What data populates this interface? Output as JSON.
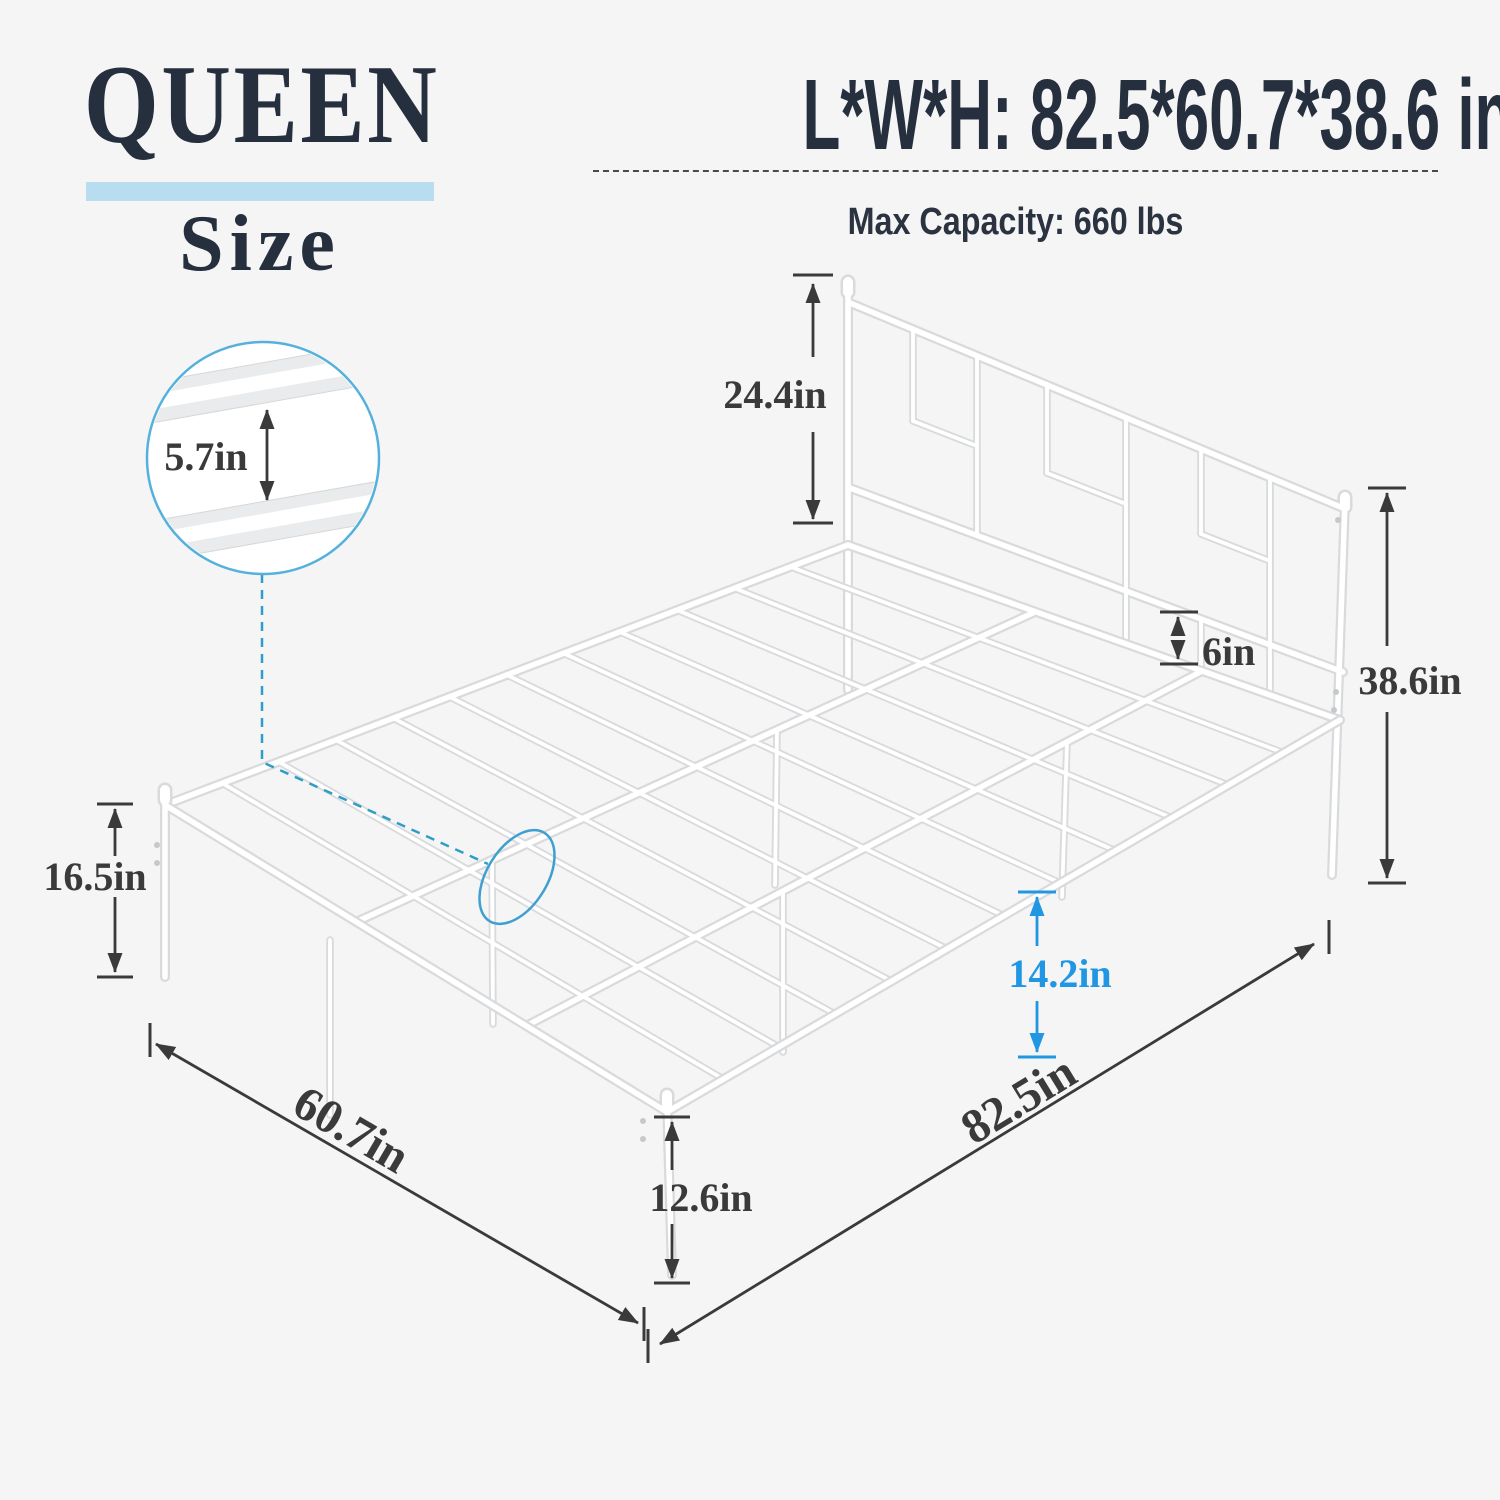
{
  "header": {
    "size_name": "QUEEN",
    "size_word": "Size"
  },
  "specs": {
    "dimensions": "L*W*H: 82.5*60.7*38.6 in",
    "max_capacity": "Max Capacity: 660 lbs"
  },
  "dimension_labels": {
    "headboard_height": "24.4in",
    "slat_gap": "5.7in",
    "headboard_rail_gap": "6in",
    "total_height": "38.6in",
    "frame_height": "16.5in",
    "under_bed_clearance": "14.2in",
    "leg_height": "12.6in",
    "bed_width": "60.7in",
    "bed_length": "82.5in"
  },
  "colors": {
    "background": "#f5f5f6",
    "heading_navy": "#262f3e",
    "highlight_bar_blue": "#b9ddf0",
    "dimension_text": "#3a3a3a",
    "accent_blue": "#2196e3",
    "callout_circle_blue": "#55b1dc",
    "connector_teal": "#2f9ec6",
    "tube_edge_gray": "#d8dadc"
  }
}
